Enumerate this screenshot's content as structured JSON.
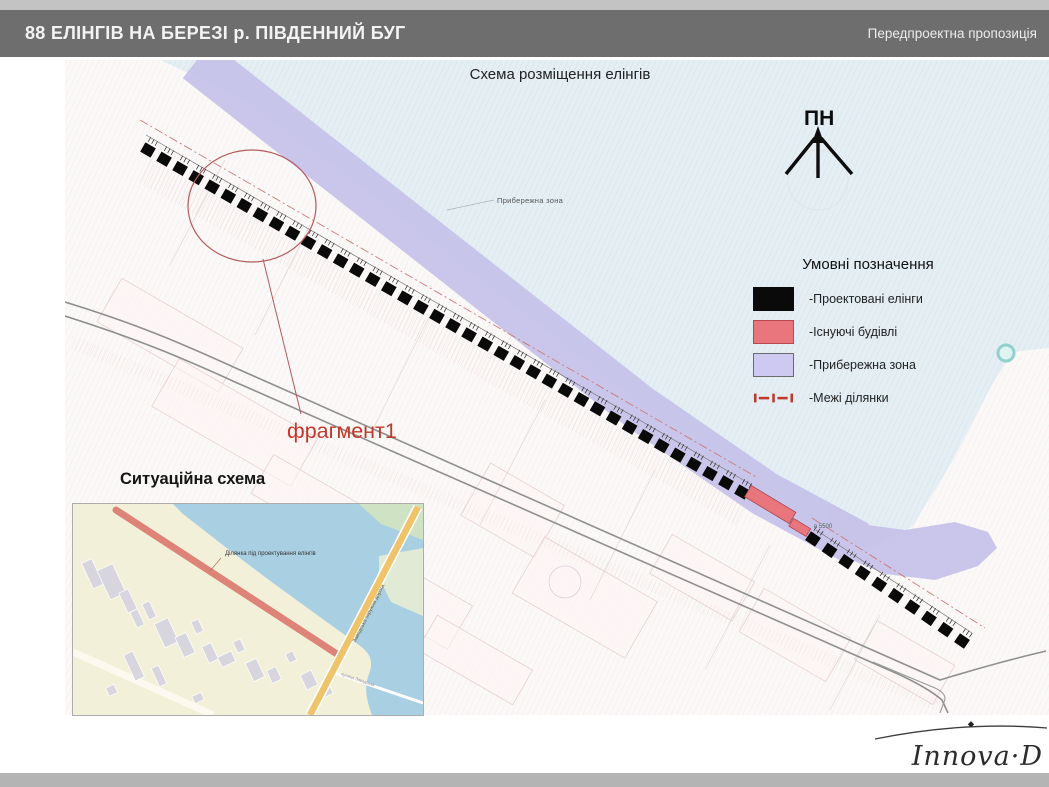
{
  "header": {
    "title": "88 ЕЛІНГІВ НА БЕРЕЗІ р. ПІВДЕННИЙ БУГ",
    "subtitle": "Передпроектна пропозиція"
  },
  "map": {
    "title": "Схема розміщення елінгів",
    "north_label": "ПН",
    "coastal_label": "Прибережна зона",
    "fragment_label": "фрагмент1",
    "elevation_label": "в 5500",
    "square_size": 12,
    "elingi_runs": [
      {
        "x1": 148,
        "y1": 150,
        "x2": 742,
        "y2": 492,
        "count": 38
      },
      {
        "x1": 813,
        "y1": 539,
        "x2": 962,
        "y2": 641,
        "count": 10
      }
    ],
    "colors": {
      "eling": "#0a0a0a",
      "existing_building": "#e8767c",
      "coastal_band": "#c6c1e9",
      "water": "#e4eef3",
      "boundary_red": "#c0392b",
      "annotation_red": "#c0392b"
    }
  },
  "legend": {
    "title": "Умовні позначення",
    "items": [
      {
        "label": "-Проектовані елінги",
        "color": "#0a0a0a",
        "border": "#0a0a0a",
        "type": "fill"
      },
      {
        "label": "-Існуючі будівлі",
        "color": "#e9767d",
        "border": "#b5494f",
        "type": "fill"
      },
      {
        "label": "-Прибережна зона",
        "color": "#cdc9f0",
        "border": "#6b6b6b",
        "type": "fill"
      },
      {
        "label": "-Межі ділянки",
        "color": "#c0392b",
        "border": "#c0392b",
        "type": "boundary"
      }
    ]
  },
  "inset": {
    "title": "Ситуаційна схема",
    "site_label": "Ділянка під проектування елінгів",
    "road_label": "Заводська окружна дорога",
    "street_label": "вулиця Заводська"
  },
  "logo": {
    "text": "Innova·D"
  }
}
